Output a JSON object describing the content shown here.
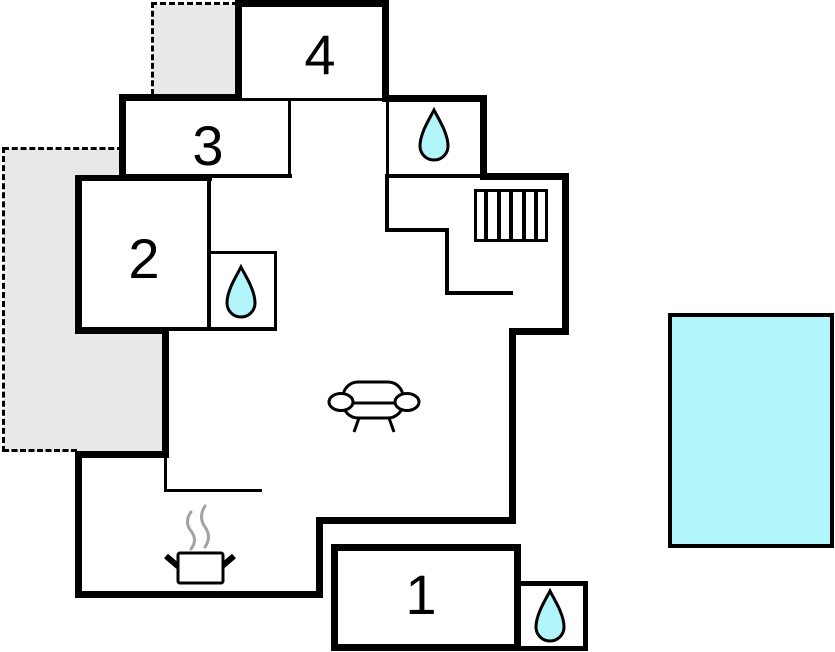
{
  "diagram": {
    "type": "floor-plan",
    "rooms": [
      {
        "id": "room-1",
        "label": "1"
      },
      {
        "id": "room-2",
        "label": "2"
      },
      {
        "id": "room-3",
        "label": "3"
      },
      {
        "id": "room-4",
        "label": "4"
      }
    ],
    "icons": [
      {
        "name": "water-drop",
        "meaning": "bathroom",
        "count": 3
      },
      {
        "name": "sofa",
        "meaning": "living-area",
        "count": 1
      },
      {
        "name": "stove-pot-with-steam",
        "meaning": "kitchen",
        "count": 1
      },
      {
        "name": "stairs",
        "meaning": "staircase",
        "count": 1
      }
    ],
    "outdoor": [
      {
        "name": "swimming-pool",
        "count": 1
      },
      {
        "name": "terrace-dashed-area",
        "count": 2
      }
    ]
  },
  "colors": {
    "wall": "#000000",
    "terrace": "#e8e8e8",
    "water": "#b2f6fb",
    "steam": "#a3a3a3",
    "bg": "#ffffff"
  }
}
